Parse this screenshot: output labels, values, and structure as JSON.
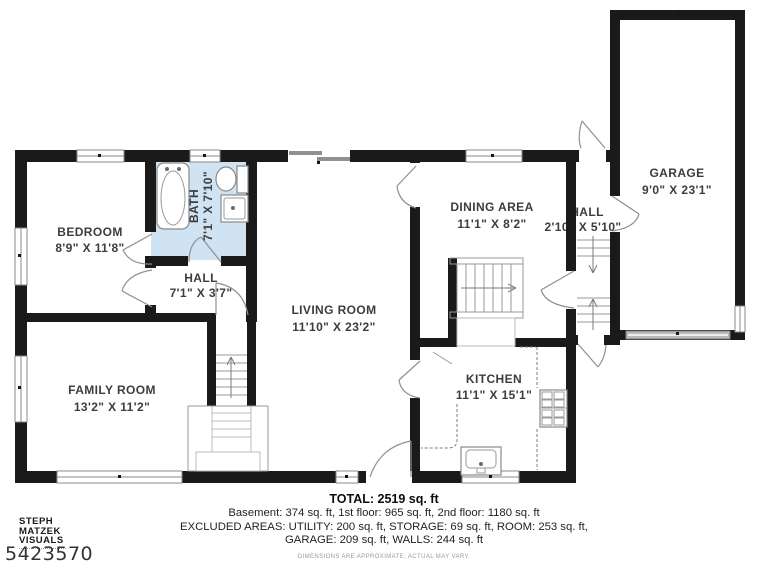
{
  "rooms": {
    "bedroom": {
      "name": "BEDROOM",
      "dims": "8'9\" X 11'8\""
    },
    "bath": {
      "name": "BATH",
      "dims": "7'1\" X 7'10\""
    },
    "hall_left": {
      "name": "HALL",
      "dims": "7'1\" X 3'7\""
    },
    "family": {
      "name": "FAMILY ROOM",
      "dims": "13'2\" X 11'2\""
    },
    "living": {
      "name": "LIVING ROOM",
      "dims": "11'10\" X 23'2\""
    },
    "dining": {
      "name": "DINING AREA",
      "dims": "11'1\" X 8'2\""
    },
    "kitchen": {
      "name": "KITCHEN",
      "dims": "11'1\" X 15'1\""
    },
    "hall_right": {
      "name": "HALL",
      "dims": "2'10\" X 5'10\""
    },
    "garage": {
      "name": "GARAGE",
      "dims": "9'0\" X 23'1\""
    }
  },
  "footer": {
    "total": "TOTAL: 2519 sq. ft",
    "floors": "Basement: 374 sq. ft, 1st floor: 965 sq. ft, 2nd floor: 1180 sq. ft",
    "excluded_line1": "EXCLUDED AREAS: UTILITY: 200 sq. ft, STORAGE: 69 sq. ft, ROOM: 253 sq. ft,",
    "excluded_line2": "GARAGE: 209 sq. ft, WALLS: 244 sq. ft",
    "disclaimer": "DIMENSIONS ARE APPROXIMATE; ACTUAL MAY VARY."
  },
  "watermark": {
    "line1": "STEPH",
    "line2": "MATZEK",
    "line3": "VISUALS"
  },
  "listing_id": "5423570",
  "colors": {
    "wall": "#1a1a1a",
    "bath_fill": "#cfe3f3",
    "plan_line_gray": "#8a8a8a",
    "label_text": "#3d3d3d"
  }
}
